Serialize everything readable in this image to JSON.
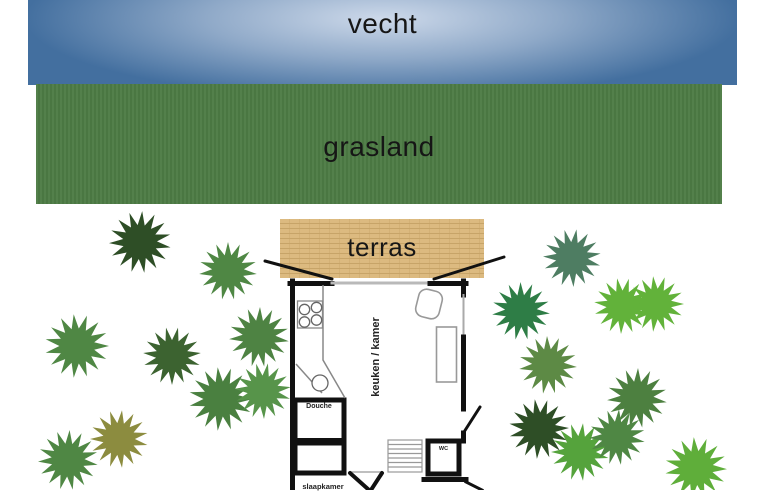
{
  "areas": {
    "river": {
      "label": "vecht"
    },
    "grass": {
      "label": "grasland"
    },
    "terrace": {
      "label": "terras"
    }
  },
  "house": {
    "rooms": [
      {
        "name": "living-kitchen",
        "label": "keuken / kamer"
      },
      {
        "name": "shower",
        "label": "Douche"
      },
      {
        "name": "toilet",
        "label": "WC"
      },
      {
        "name": "bedroom",
        "label": "slaapkamer"
      }
    ]
  },
  "colors": {
    "river_center": "#cdd9ea",
    "river_mid": "#8fa9c8",
    "river_edge": "#436f9f",
    "grass": "#4c7b44",
    "terrace": "#dcba80",
    "terrace_line": "#c7a468",
    "wall": "#111111",
    "thin_line": "#8a8a8a"
  },
  "trees": [
    {
      "x": 140,
      "y": 242,
      "r": 31,
      "rot": 10,
      "color": "#2e4e26"
    },
    {
      "x": 228,
      "y": 271,
      "r": 29,
      "rot": 30,
      "color": "#4f8744"
    },
    {
      "x": 77,
      "y": 346,
      "r": 32,
      "rot": 0,
      "color": "#4f8744"
    },
    {
      "x": 172,
      "y": 356,
      "r": 29,
      "rot": 18,
      "color": "#3c6330"
    },
    {
      "x": 259,
      "y": 337,
      "r": 30,
      "rot": 8,
      "color": "#4e8343"
    },
    {
      "x": 221,
      "y": 399,
      "r": 32,
      "rot": 24,
      "color": "#4a8040"
    },
    {
      "x": 263,
      "y": 391,
      "r": 28,
      "rot": 40,
      "color": "#57944a"
    },
    {
      "x": 119,
      "y": 439,
      "r": 29,
      "rot": 12,
      "color": "#8c8c3f"
    },
    {
      "x": 68,
      "y": 460,
      "r": 30,
      "rot": 33,
      "color": "#4f8744"
    },
    {
      "x": 572,
      "y": 258,
      "r": 29,
      "rot": 15,
      "color": "#4e7d62"
    },
    {
      "x": 521,
      "y": 311,
      "r": 29,
      "rot": 5,
      "color": "#2e7d46"
    },
    {
      "x": 622,
      "y": 306,
      "r": 28,
      "rot": 20,
      "color": "#62b23a"
    },
    {
      "x": 656,
      "y": 304,
      "r": 28,
      "rot": 48,
      "color": "#62b23a"
    },
    {
      "x": 548,
      "y": 365,
      "r": 29,
      "rot": 28,
      "color": "#5d8a45"
    },
    {
      "x": 637,
      "y": 398,
      "r": 30,
      "rot": 8,
      "color": "#4d8040"
    },
    {
      "x": 539,
      "y": 429,
      "r": 30,
      "rot": 22,
      "color": "#2e4e26"
    },
    {
      "x": 580,
      "y": 452,
      "r": 29,
      "rot": 36,
      "color": "#55a33c"
    },
    {
      "x": 617,
      "y": 437,
      "r": 28,
      "rot": 10,
      "color": "#4f8744"
    },
    {
      "x": 696,
      "y": 468,
      "r": 31,
      "rot": 26,
      "color": "#5fae3a"
    }
  ]
}
